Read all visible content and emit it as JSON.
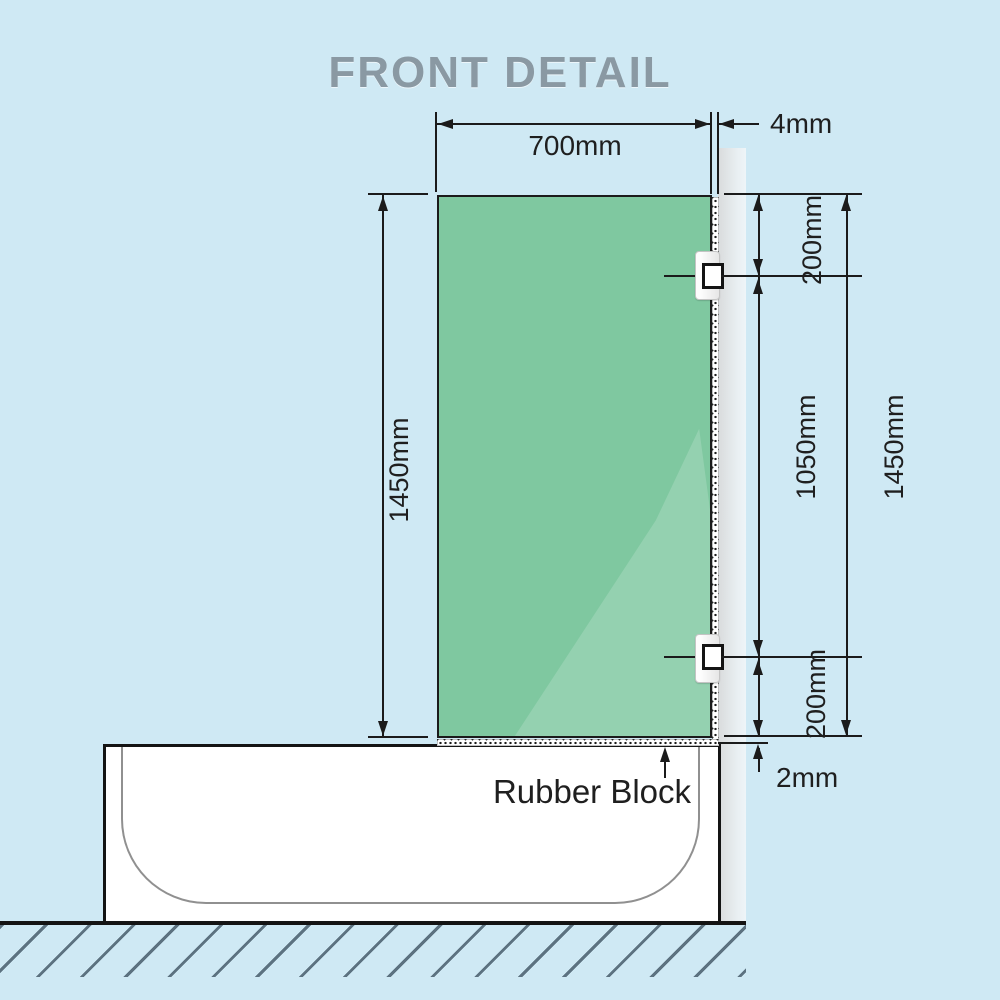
{
  "title": "FRONT DETAIL",
  "colors": {
    "background": "#cfe9f4",
    "glass": "#7fc8a0",
    "wall": "#d9dbdc",
    "line": "#1b1b1b",
    "title_text": "#8a99a3",
    "hatch": "#5c7280",
    "tub_inner_outline": "#909090"
  },
  "dimensions": {
    "glass_width": "700mm",
    "wall_gap": "4mm",
    "glass_height_left": "1450mm",
    "top_bracket_offset": "200mm",
    "bracket_spacing": "1050mm",
    "glass_height_right": "1450mm",
    "bottom_bracket_offset": "200mm",
    "floor_gap": "2mm"
  },
  "annotations": {
    "rubber_block": "Rubber Block"
  }
}
